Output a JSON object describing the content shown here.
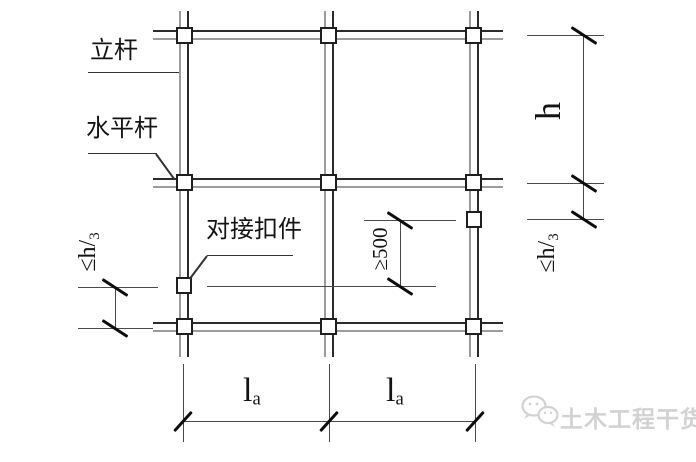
{
  "labels": {
    "vertical_pole": "立杆",
    "horizontal_bar": "水平杆",
    "butt_coupler": "对接扣件"
  },
  "dim_text": {
    "story_height": "h",
    "leq_main": "≤h/",
    "leq_sub": "3",
    "min_stagger": "≥500",
    "span_main": "l",
    "span_sub": "a"
  },
  "dimensions_summary": {
    "right_story_height": "h",
    "right_coupler_offset": "≤h/3",
    "left_coupler_offset": "≤h/3",
    "coupler_stagger_min": "≥500",
    "bay_spans": [
      "la",
      "la"
    ]
  },
  "watermark": {
    "name": "土木工程干货集",
    "logo": "wechat-bubbles-icon"
  },
  "colors": {
    "line_primary": "#2b2b2b",
    "line_secondary": "#9c9c9c",
    "dimension_line": "#4a4a4a",
    "watermark": "#d2d2d2",
    "background": "#ffffff"
  }
}
